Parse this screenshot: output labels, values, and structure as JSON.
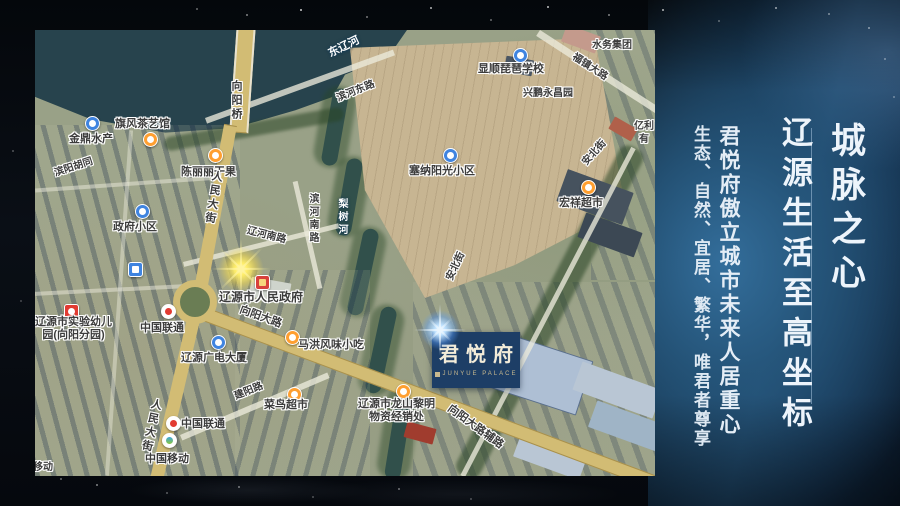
{
  "panel": {
    "headline_right": "城脉之心",
    "headline_left": "辽源生活至高坐标",
    "subline_1": "君悦府傲立城市未来人居重心",
    "subline_2": "生态、自然、宜居、繁华，唯君者尊享"
  },
  "badge": {
    "name": "君悦府",
    "subtext": "JUNYUE PALACE"
  },
  "map": {
    "labels": {
      "river_main": "东辽河",
      "river_branch": "梨树河",
      "bridge": "向阳桥",
      "road_renmin": "人民大街",
      "road_binhe_east": "滨河东路",
      "road_binhe_south": "滨河南路",
      "road_liaohe_south": "辽河南路",
      "road_fuzhen": "福镇大路",
      "road_xiangyang": "向阳大路",
      "road_xiangyang_service": "向阳大路辅路",
      "road_jianyang": "建阳路",
      "road_anbei": "安北街",
      "poi_shuiwu": "水务集团",
      "poi_pipa_school": "显顺琵琶学校",
      "poi_xingpeng": "兴鹏永昌园",
      "poi_yili_line1": "亿利",
      "poi_yili_line2": "有",
      "poi_jinding": "金鼎水产",
      "poi_qifeng": "旗风茶艺馆",
      "poi_chenlili": "陈丽丽干果",
      "poi_binyang_hutong": "滨阳胡同",
      "poi_zhengfu": "政府小区",
      "poi_sena": "塞纳阳光小区",
      "poi_hongxiang": "宏祥超市",
      "poi_government": "辽源市人民政府",
      "poi_unicom": "中国联通",
      "poi_kindergarten_line1": "辽源市实验幼儿",
      "poi_kindergarten_line2": "园(向阳分园)",
      "poi_guangdian": "辽源广电大厦",
      "poi_mahong": "马洪风味小吃",
      "poi_cainiao": "菜鸟超市",
      "poi_mobile": "中国移动",
      "poi_mobile_fragment": "移动",
      "poi_longshan_line1": "辽源市龙山黎明",
      "poi_longshan_line2": "物资经销处"
    }
  },
  "colors": {
    "panel_highlight": "#35719f",
    "badge_navy": "#1d3e66",
    "government_flare": "#ffee6a",
    "junyue_flare": "#bfe2ff",
    "main_road": "#d2bc74",
    "water": "#27434d"
  }
}
